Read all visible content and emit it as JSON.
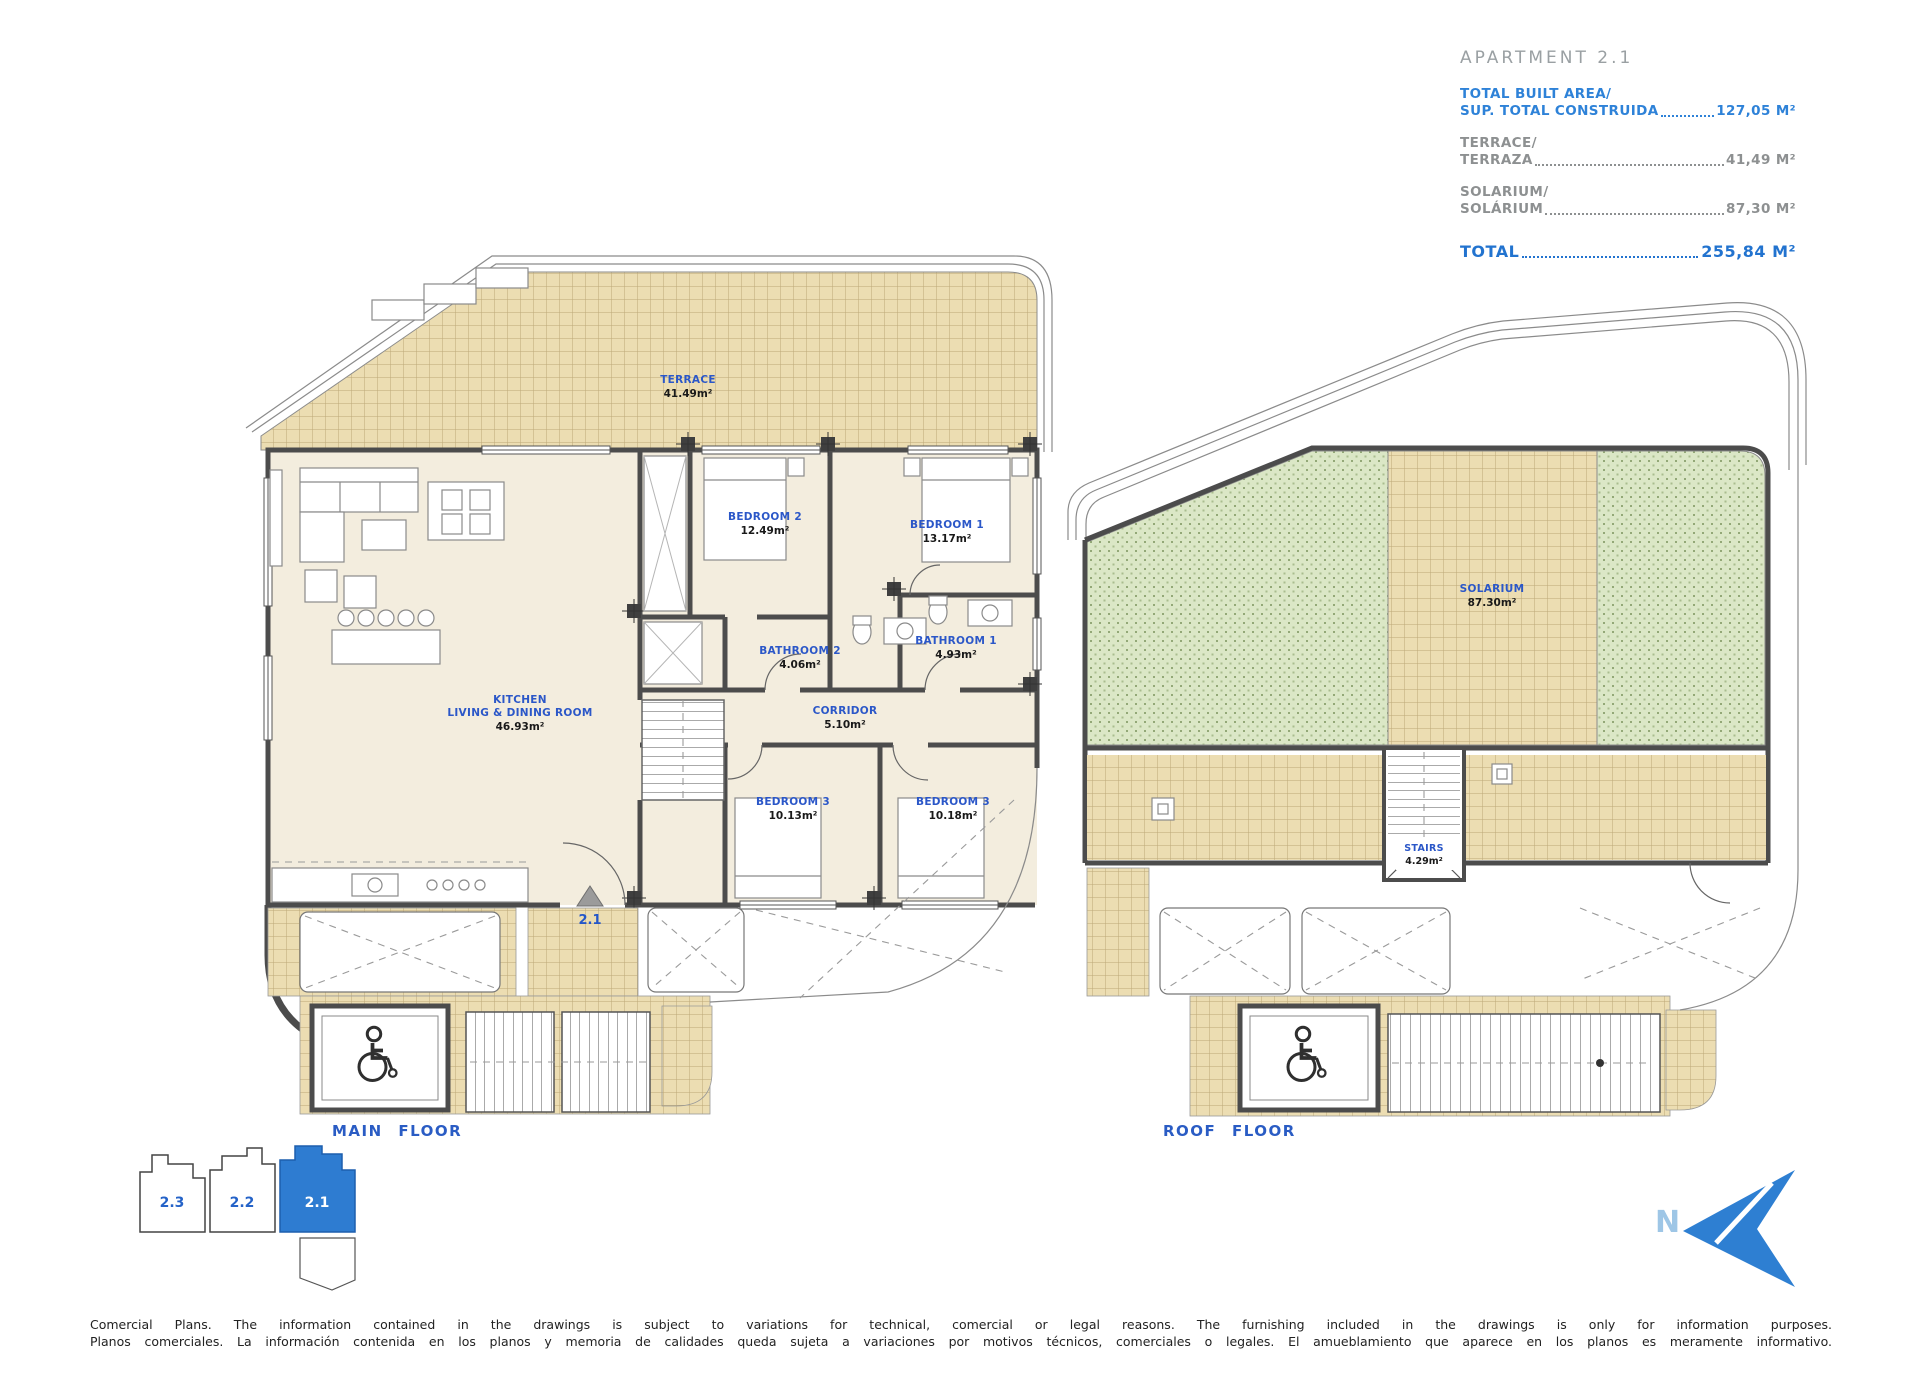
{
  "info_panel": {
    "title": "APARTMENT 2.1",
    "rows": [
      {
        "label_line1": "TOTAL BUILT AREA/",
        "label_line2": "SUP. TOTAL CONSTRUIDA",
        "value": "127,05 M²"
      },
      {
        "label_line1": "TERRACE/",
        "label_line2": "TERRAZA",
        "value": "41,49 M²"
      },
      {
        "label_line1": "SOLARIUM/",
        "label_line2": "SOLÁRIUM",
        "value": "87,30 M²"
      }
    ],
    "total": {
      "label": "TOTAL ",
      "value": "255,84 M²"
    }
  },
  "main_floor": {
    "caption": "MAIN FLOOR",
    "entrance_unit_label": "2.1",
    "rooms": [
      {
        "name": "TERRACE",
        "area": "41.49m²"
      },
      {
        "name": "BEDROOM 2",
        "area": "12.49m²"
      },
      {
        "name": "BEDROOM 1",
        "area": "13.17m²"
      },
      {
        "name": "BATHROOM 2",
        "area": "4.06m²"
      },
      {
        "name": "BATHROOM 1",
        "area": "4.93m²"
      },
      {
        "name": "CORRIDOR",
        "area": "5.10m²"
      },
      {
        "name_line1": "KITCHEN",
        "name_line2": "LIVING & DINING ROOM",
        "area": "46.93m²"
      },
      {
        "name": "BEDROOM 3",
        "area": "10.13m²"
      },
      {
        "name": "BEDROOM 3",
        "area": "10.18m²"
      }
    ]
  },
  "roof_floor": {
    "caption": "ROOF FLOOR",
    "rooms": [
      {
        "name": "SOLARIUM",
        "area": "87.30m²"
      },
      {
        "name": "STAIRS",
        "area": "4.29m²"
      }
    ]
  },
  "key_plan": {
    "units": [
      {
        "label": "2.3"
      },
      {
        "label": "2.2"
      },
      {
        "label": "2.1"
      }
    ],
    "selected": "2.1"
  },
  "compass": {
    "label": "N"
  },
  "disclaimer": {
    "line1": "Comercial Plans. The information contained in the drawings is subject to variations for technical, comercial or legal reasons. The furnishing included in the drawings is only for information purposes.",
    "line2": "Planos comerciales. La información contenida en los planos y memoria de calidades queda sujeta a variaciones por motivos técnicos, comerciales o legales. El amueblamiento que aparece en los planos es meramente informativo."
  },
  "colors": {
    "accent_blue": "#2e7fd2",
    "label_blue": "#2b57c8",
    "panel_blue": "#2e82d8",
    "panel_gray": "#8d9091",
    "tile_tan": "#ecddb2",
    "grass_green": "#dbe7c6",
    "wall_gray": "#4c4c4c"
  }
}
